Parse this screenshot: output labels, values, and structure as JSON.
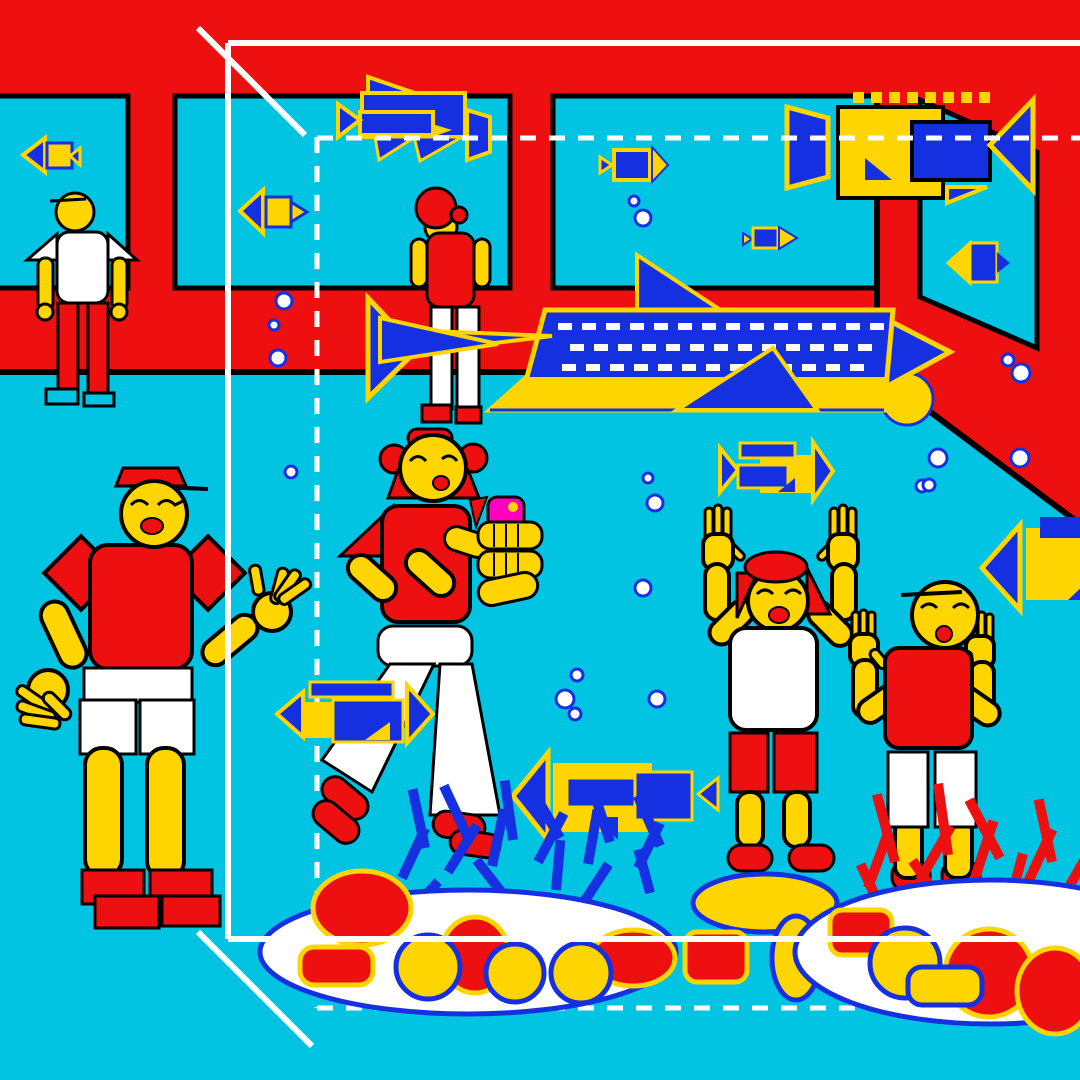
{
  "title": "Aquarium scene illustration",
  "palette": {
    "cyan": "#00C4E2",
    "red": "#EE1010",
    "yellow": "#FFD500",
    "blue": "#1530E0",
    "magenta": "#FF00BE",
    "white": "#FFFFFF",
    "black": "#000000"
  },
  "scene": {
    "figures": [
      "man-at-window",
      "child-back-view",
      "man-waving",
      "woman-taking-photo",
      "girl-cheering",
      "boy-cheering"
    ],
    "camera_fish_count": 12,
    "bubbles": [
      [
        284,
        301,
        8
      ],
      [
        274,
        325,
        5
      ],
      [
        278,
        358,
        8
      ],
      [
        291,
        472,
        6
      ],
      [
        634,
        201,
        5
      ],
      [
        643,
        218,
        8
      ],
      [
        648,
        478,
        5
      ],
      [
        655,
        503,
        8
      ],
      [
        922,
        486,
        6
      ],
      [
        1008,
        360,
        6
      ],
      [
        1021,
        373,
        9
      ],
      [
        938,
        458,
        9
      ],
      [
        929,
        485,
        6
      ],
      [
        1020,
        458,
        9
      ],
      [
        643,
        588,
        8
      ],
      [
        577,
        675,
        6
      ],
      [
        565,
        699,
        9
      ],
      [
        575,
        714,
        6
      ],
      [
        657,
        699,
        8
      ]
    ],
    "blue_spikes": [
      [
        402,
        878,
        25,
        55
      ],
      [
        425,
        848,
        -12,
        60
      ],
      [
        448,
        872,
        32,
        55
      ],
      [
        470,
        842,
        -25,
        62
      ],
      [
        492,
        866,
        12,
        58
      ],
      [
        513,
        840,
        -8,
        60
      ],
      [
        538,
        862,
        28,
        55
      ],
      [
        560,
        838,
        -30,
        60
      ],
      [
        588,
        864,
        10,
        55
      ],
      [
        610,
        842,
        -18,
        58
      ],
      [
        638,
        868,
        26,
        50
      ],
      [
        660,
        846,
        -24,
        55
      ],
      [
        408,
        915,
        42,
        45
      ],
      [
        506,
        898,
        -38,
        48
      ],
      [
        584,
        902,
        33,
        45
      ],
      [
        650,
        893,
        -15,
        45
      ],
      [
        556,
        890,
        5,
        50
      ]
    ],
    "red_spikes": [
      [
        868,
        888,
        20,
        60
      ],
      [
        895,
        862,
        -15,
        70
      ],
      [
        920,
        880,
        30,
        62
      ],
      [
        948,
        855,
        -8,
        72
      ],
      [
        975,
        878,
        18,
        60
      ],
      [
        1000,
        858,
        -28,
        66
      ],
      [
        1028,
        882,
        25,
        58
      ],
      [
        1052,
        862,
        -12,
        64
      ],
      [
        1070,
        885,
        30,
        55
      ],
      [
        940,
        900,
        -35,
        48
      ],
      [
        1010,
        902,
        15,
        50
      ],
      [
        880,
        906,
        -25,
        46
      ]
    ],
    "yellow_dots": {
      "x0": 853,
      "y": 92,
      "step": 18,
      "size": 11,
      "count": 8
    },
    "shark_spots": {
      "rows": [
        {
          "y": 323,
          "x0": 558,
          "n": 14
        },
        {
          "y": 344,
          "x0": 570,
          "n": 13
        },
        {
          "y": 364,
          "x0": 562,
          "n": 13
        }
      ],
      "w": 14,
      "h": 7,
      "step": 24
    }
  }
}
